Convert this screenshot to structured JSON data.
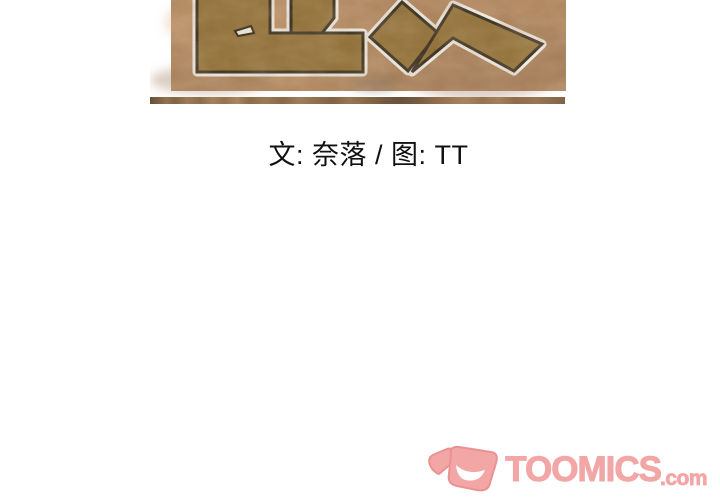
{
  "page": {
    "background_color": "#ffffff"
  },
  "banner": {
    "description": "cropped bottom of comic title artwork with large outlined Chinese characters on mottled brown texture",
    "background_color": "#b2855d",
    "glyph_fill": "#8a682a",
    "glyph_outline": "#1a140b",
    "glyph_halo": "#ffffff",
    "cutout_fill": "#fdfcf6",
    "strip_base": "#8a6a4c"
  },
  "credits": {
    "text": "文: 奈落 / 图: TT",
    "color": "#111111"
  },
  "watermark": {
    "brand": "TOOMICS",
    "suffix": ".com",
    "fill": "#f3a6a6",
    "outline": "#eb9191",
    "smile": "#ffffff"
  }
}
